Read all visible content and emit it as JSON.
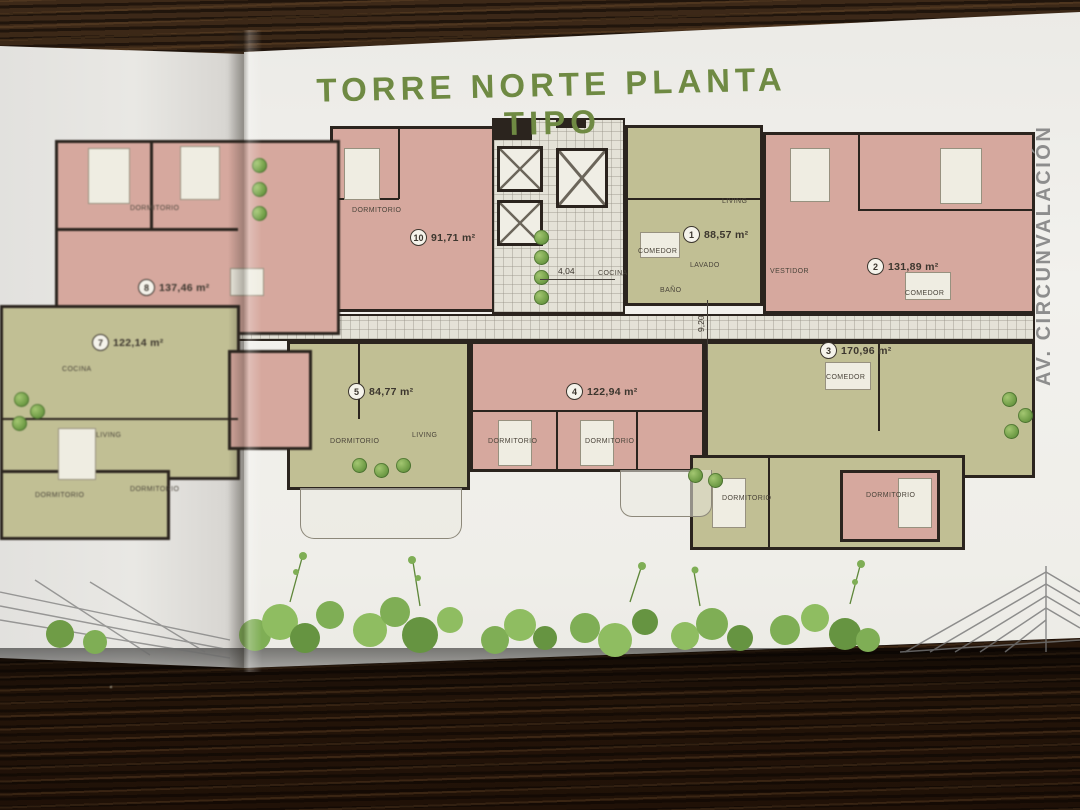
{
  "page": {
    "title": "TORRE NORTE PLANTA TIPO",
    "street_label": "AV. CIRCUNVALACIÓN"
  },
  "units": {
    "u1": {
      "number": "1",
      "area": "88,57 m²"
    },
    "u2": {
      "number": "2",
      "area": "131,89 m²"
    },
    "u3": {
      "number": "3",
      "area": "170,96 m²"
    },
    "u4": {
      "number": "4",
      "area": "122,94 m²"
    },
    "u5": {
      "number": "5",
      "area": "84,77 m²"
    },
    "u7": {
      "number": "7",
      "area": "122,14 m²"
    },
    "u8": {
      "number": "8",
      "area": "137,46 m²"
    },
    "u10": {
      "number": "10",
      "area": "91,71 m²"
    }
  },
  "rooms": {
    "dormitorio": "DORMITORIO",
    "living": "LIVING",
    "comedor": "COMEDOR",
    "cocina": "COCINA",
    "lavado": "LAVADO",
    "bano": "BAÑO",
    "vestidor": "VESTIDOR"
  },
  "dimensions": {
    "corridor_width": "4,04",
    "corridor_length": "9,20"
  },
  "colors": {
    "accent_green": "#6f8a43",
    "apartment_pink": "#d6a89e",
    "apartment_olive": "#c1bf94",
    "street_label_gray": "#8d8d8d",
    "wood_brown": "#2c1c0e"
  }
}
